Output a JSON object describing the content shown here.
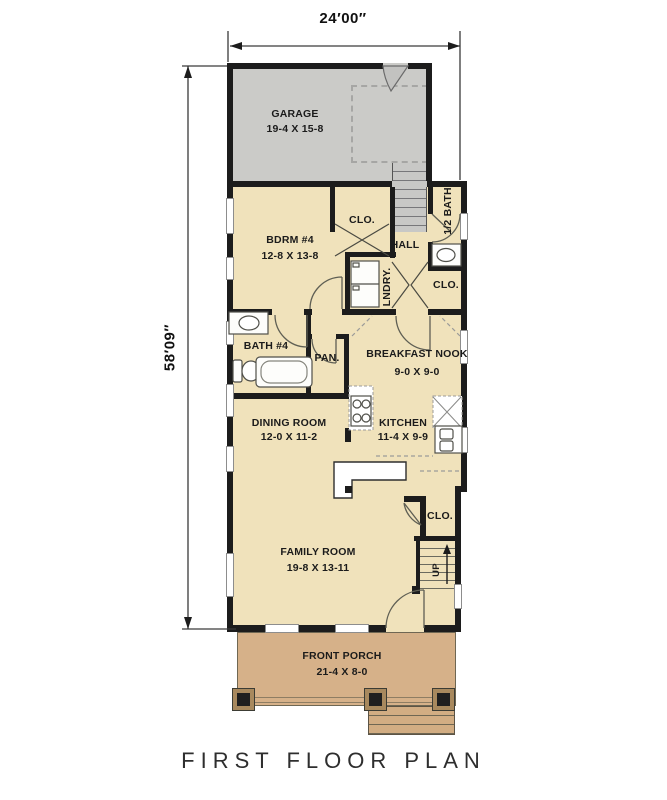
{
  "title": "FIRST FLOOR PLAN",
  "dimensions": {
    "width_label": "24′00″",
    "height_label": "58′09″"
  },
  "rooms": {
    "garage": {
      "name": "GARAGE",
      "size": "19-4 X 15-8"
    },
    "bdrm4": {
      "name": "BDRM #4",
      "size": "12-8 X 13-8"
    },
    "bdrm4_closet": {
      "name": "CLO."
    },
    "hall": {
      "name": "HALL"
    },
    "half_bath": {
      "name": "1/2 BATH"
    },
    "laundry": {
      "name": "LNDRY."
    },
    "hall_closet": {
      "name": "CLO."
    },
    "bath4": {
      "name": "BATH #4"
    },
    "pantry": {
      "name": "PAN."
    },
    "breakfast_nook": {
      "name": "BREAKFAST NOOK",
      "size": "9-0 X 9-0"
    },
    "dining_room": {
      "name": "DINING ROOM",
      "size": "12-0 X 11-2"
    },
    "kitchen": {
      "name": "KITCHEN",
      "size": "11-4 X 9-9"
    },
    "entry_closet": {
      "name": "CLO."
    },
    "family_room": {
      "name": "FAMILY ROOM",
      "size": "19-8 X 13-11"
    },
    "front_porch": {
      "name": "FRONT PORCH",
      "size": "21-4 X 8-0"
    }
  },
  "stairs": {
    "up_label": "UP"
  },
  "colors": {
    "wall": "#1c1c1c",
    "room_fill": "#f0e2bb",
    "garage_fill": "#cbcbc8",
    "porch_fill": "#d6b189",
    "line": "#5f5f54"
  }
}
